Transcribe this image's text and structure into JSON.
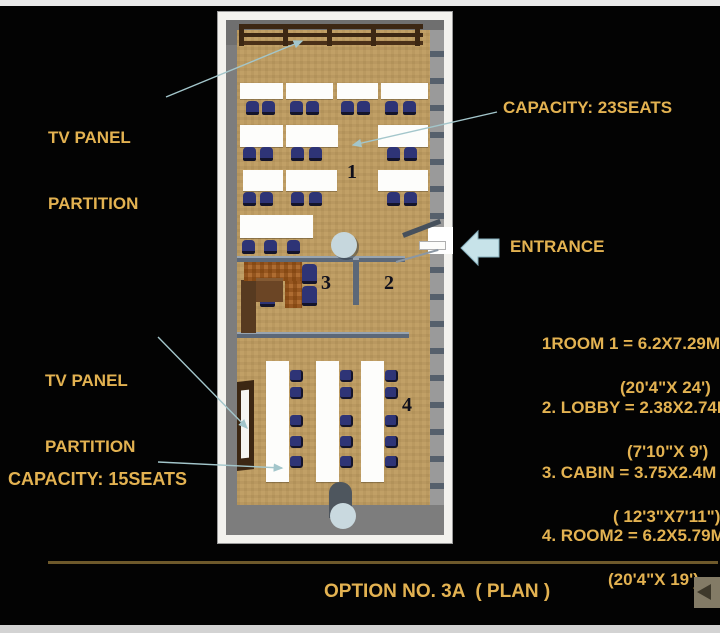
{
  "colors": {
    "background": "#030303",
    "gold": "#E3B251",
    "leader": "#A3C6CB",
    "arrow_fill": "#C7E3E9",
    "arrow_stroke": "#86AFBC",
    "tv_brown": "#3C2713",
    "chair_blue": "#2E3476",
    "slate_wall": "#5C6878"
  },
  "annotations": {
    "tv_panel_top_label": {
      "line1": "TV PANEL",
      "line2": "PARTITION"
    },
    "capacity_room1": "CAPACITY: 23SEATS",
    "entrance": "ENTRANCE",
    "tv_panel_left_label": {
      "line1": "TV PANEL",
      "line2": "PARTITION"
    },
    "capacity_room2": "CAPACITY: 15SEATS"
  },
  "icons": {
    "entrance_arrow": "arrow-left-icon",
    "back_button": "back-arrow-icon"
  },
  "plan": {
    "room_numbers": {
      "room1": "1",
      "lobby": "2",
      "cabin": "3",
      "room2": "4"
    },
    "furniture": {
      "desks": [
        [
          23,
          72,
          43,
          16
        ],
        [
          69,
          72,
          47,
          16
        ],
        [
          120,
          72,
          41,
          16
        ],
        [
          164,
          72,
          47,
          16
        ],
        [
          23,
          114,
          43,
          22
        ],
        [
          69,
          114,
          52,
          22
        ],
        [
          161,
          114,
          50,
          22
        ],
        [
          26,
          159,
          40,
          21
        ],
        [
          69,
          159,
          51,
          21
        ],
        [
          161,
          159,
          50,
          21
        ],
        [
          23,
          204,
          73,
          23
        ],
        [
          49,
          350,
          23,
          121
        ],
        [
          99,
          350,
          23,
          121
        ],
        [
          144,
          350,
          23,
          121
        ]
      ],
      "chairs_room1": [
        [
          29,
          90
        ],
        [
          45,
          90
        ],
        [
          73,
          90
        ],
        [
          89,
          90
        ],
        [
          124,
          90
        ],
        [
          140,
          90
        ],
        [
          168,
          90
        ],
        [
          186,
          90
        ],
        [
          26,
          136
        ],
        [
          43,
          136
        ],
        [
          74,
          136
        ],
        [
          92,
          136
        ],
        [
          170,
          136
        ],
        [
          187,
          136
        ],
        [
          26,
          181
        ],
        [
          43,
          181
        ],
        [
          74,
          181
        ],
        [
          92,
          181
        ],
        [
          170,
          181
        ],
        [
          187,
          181
        ],
        [
          25,
          229
        ],
        [
          47,
          229
        ],
        [
          70,
          229
        ]
      ],
      "chairs_room2": [
        [
          73,
          359
        ],
        [
          73,
          376
        ],
        [
          73,
          404
        ],
        [
          73,
          425
        ],
        [
          73,
          445
        ],
        [
          123,
          359
        ],
        [
          123,
          376
        ],
        [
          123,
          404
        ],
        [
          123,
          425
        ],
        [
          123,
          445
        ],
        [
          168,
          359
        ],
        [
          168,
          376
        ],
        [
          168,
          404
        ],
        [
          168,
          425
        ],
        [
          168,
          445
        ]
      ],
      "chairs_cabin": [
        [
          85,
          253
        ],
        [
          85,
          275
        ],
        [
          43,
          276
        ]
      ],
      "walls": [
        [
          20,
          245,
          168,
          6
        ],
        [
          136,
          247,
          6,
          47
        ],
        [
          20,
          321,
          172,
          6
        ]
      ]
    }
  },
  "dimensions": [
    {
      "line1": "1ROOM 1 = 6.2X7.29M",
      "line2": "(20'4\"X 24')",
      "indent": 97
    },
    {
      "line1": "2. LOBBY = 2.38X2.74M",
      "line2": "(7'10\"X 9')",
      "indent": 104
    },
    {
      "line1": "3. CABIN = 3.75X2.4M",
      "line2": "( 12'3\"X7'11\")",
      "indent": 90
    },
    {
      "line1": "4. ROOM2 = 6.2X5.79M",
      "line2": "(20'4\"X 19')",
      "indent": 85
    }
  ],
  "footer": {
    "title": "OPTION NO. 3A  ( PLAN )"
  }
}
